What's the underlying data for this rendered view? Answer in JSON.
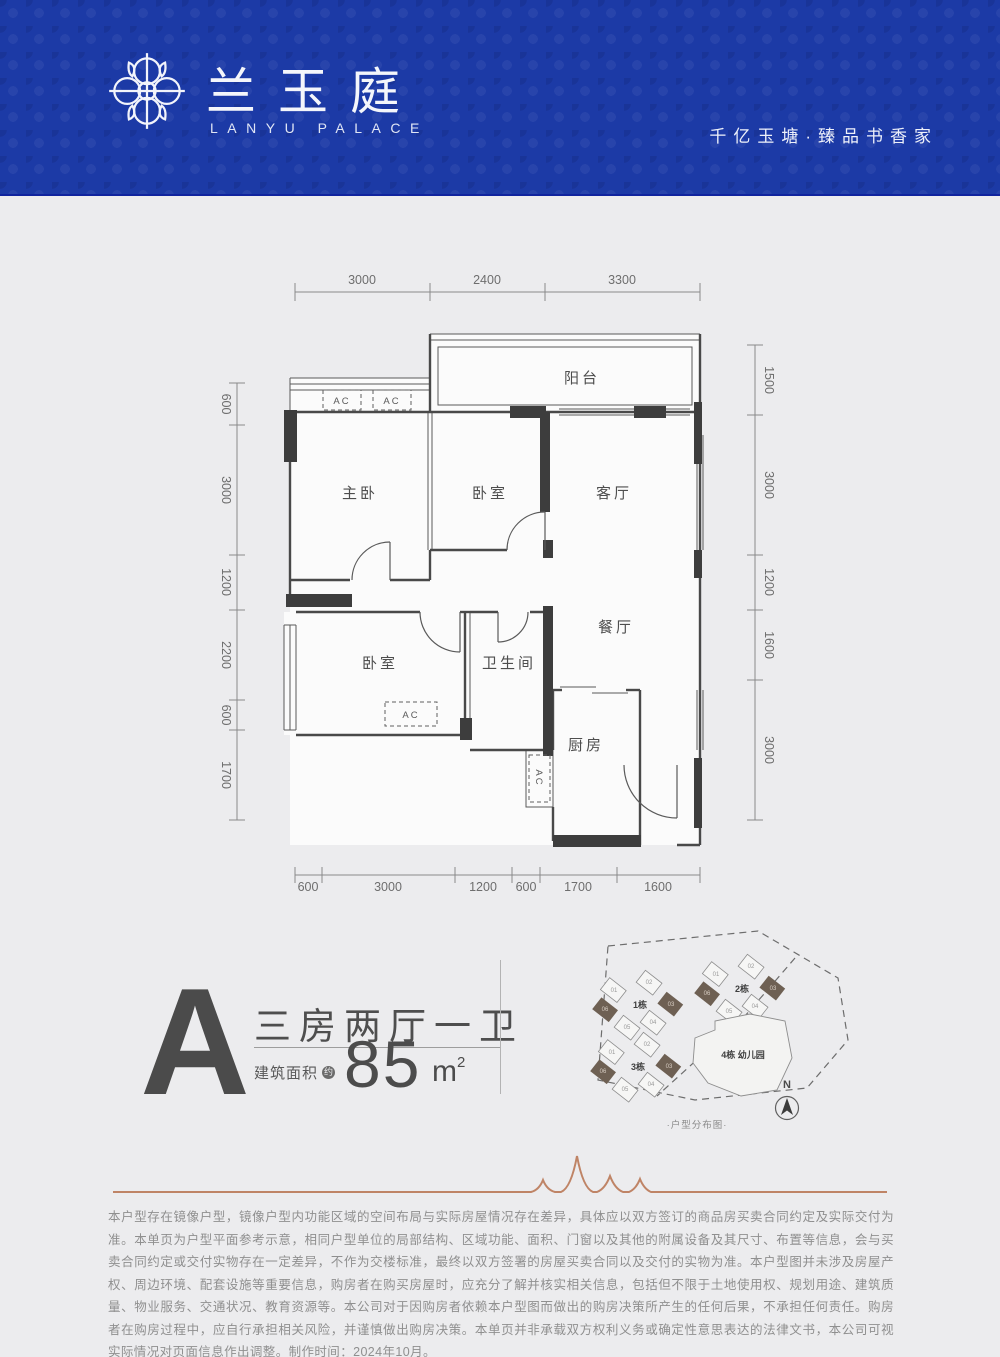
{
  "header": {
    "brand_cn": "兰玉庭",
    "brand_en": "LANYU PALACE",
    "tagline": "千亿玉塘·臻品书香家"
  },
  "floorplan": {
    "rooms": {
      "balcony": "阳台",
      "master": "主卧",
      "bedroom2": "卧室",
      "living": "客厅",
      "dining": "餐厅",
      "bedroom3": "卧室",
      "bath": "卫生间",
      "kitchen": "厨房"
    },
    "ac_label": "AC",
    "dims": {
      "top": [
        "3000",
        "2400",
        "3300"
      ],
      "bottom": [
        "600",
        "3000",
        "1200",
        "600",
        "1700",
        "1600"
      ],
      "left": [
        "600",
        "3000",
        "1200",
        "2200",
        "600",
        "1700"
      ],
      "right": [
        "1500",
        "3000",
        "1200",
        "1600",
        "3000"
      ]
    }
  },
  "unit": {
    "letter": "A",
    "layout": "三房两厅一卫",
    "area_prefix": "建筑面积",
    "area_approx": "约",
    "area_value": "85",
    "area_unit_html": "m",
    "area_power": "2"
  },
  "siteplan": {
    "caption": "·户型分布图·",
    "north": "N",
    "buildings": [
      {
        "name": "1栋",
        "units": [
          "01",
          "02",
          "03",
          "04",
          "05",
          "06"
        ]
      },
      {
        "name": "2栋",
        "units": [
          "01",
          "02",
          "03",
          "04",
          "05",
          "06"
        ]
      },
      {
        "name": "3栋",
        "units": [
          "01",
          "02",
          "03",
          "04",
          "05",
          "06"
        ]
      },
      {
        "name": "4栋 幼儿园"
      }
    ]
  },
  "disclaimer": "本户型存在镜像户型，镜像户型内功能区域的空间布局与实际房屋情况存在差异，具体应以双方签订的商品房买卖合同约定及实际交付为准。本单页为户型平面参考示意，相同户型单位的局部结构、区域功能、面积、门窗以及其他的附属设备及其尺寸、布置等信息，会与买卖合同约定或交付实物存在一定差异，不作为交楼标准，最终以双方签署的房屋买卖合同以及交付的实物为准。本户型图并未涉及房屋产权、周边环境、配套设施等重要信息，购房者在购买房屋时，应充分了解并核实相关信息，包括但不限于土地使用权、规划用途、建筑质量、物业服务、交通状况、教育资源等。本公司对于因购房者依赖本户型图而做出的购房决策所产生的任何后果，不承担任何责任。购房者在购房过程中，应自行承担相关风险，并谨慎做出购房决策。本单页并非承载双方权利义务或确定性意思表达的法律文书，本公司可视实际情况对页面信息作出调整。制作时间：2024年10月。",
  "colors": {
    "header_blue": "#1c3aa6",
    "wall_dark": "#3d3d3d",
    "copper_accent": "#bf8466",
    "unit_highlight": "#6e6053"
  }
}
